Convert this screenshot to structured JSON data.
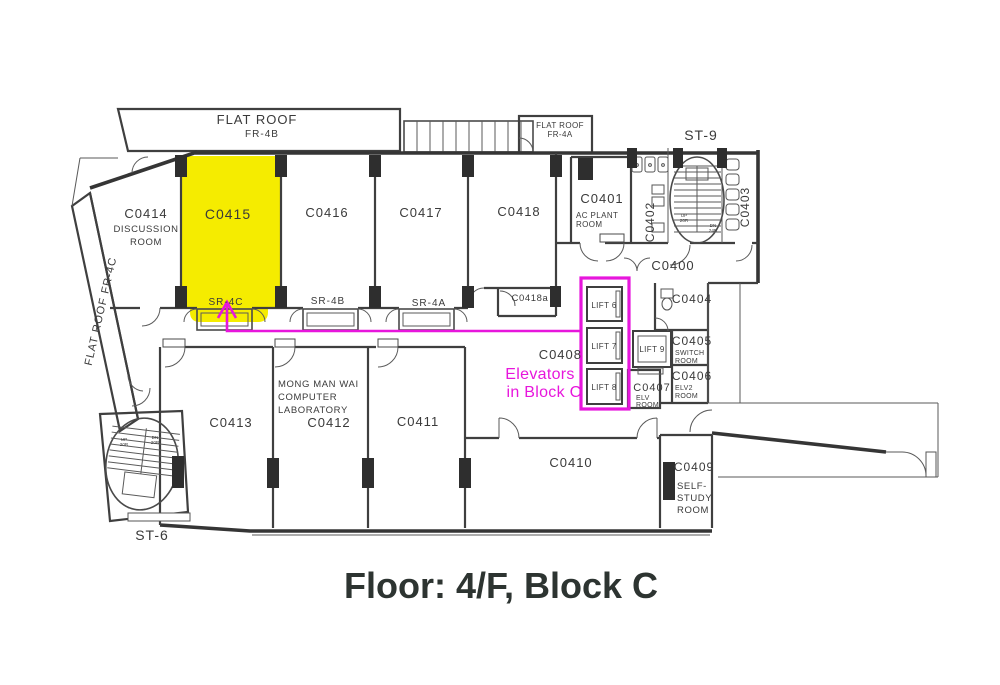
{
  "title": {
    "text": "Floor: 4/F, Block C"
  },
  "colors": {
    "highlight": "#f5ec00",
    "annotation": "#e716dc",
    "label": "#3a3a3a",
    "title": "#2d3431"
  },
  "annotation": {
    "line1": "Elevators",
    "line2": "in Block C"
  },
  "roofs": {
    "fr4b": {
      "name": "FLAT ROOF",
      "code": "FR-4B"
    },
    "fr4a": {
      "name": "FLAT ROOF",
      "code": "FR-4A"
    },
    "fr4c": {
      "name": "FLAT ROOF FR-4C"
    }
  },
  "stairs": {
    "st9": {
      "label": "ST-9",
      "up": "UP",
      "up_risers": "20R",
      "down": "DN",
      "down_risers": "24R"
    },
    "st6": {
      "label": "ST-6",
      "up": "UP",
      "up_risers": "20R",
      "down": "DN",
      "down_risers": "20R"
    }
  },
  "lifts": {
    "lift6": "LIFT 6",
    "lift7": "LIFT 7",
    "lift8": "LIFT 8",
    "lift9": "LIFT 9"
  },
  "service_rooms": {
    "sr4c": "SR-4C",
    "sr4b": "SR-4B",
    "sr4a": "SR-4A"
  },
  "rooms": {
    "c0400": {
      "label": "C0400"
    },
    "c0401": {
      "label": "C0401",
      "line1": "AC PLANT",
      "line2": "ROOM"
    },
    "c0402": {
      "label": "C0402"
    },
    "c0403": {
      "label": "C0403"
    },
    "c0404": {
      "label": "C0404"
    },
    "c0405": {
      "label": "C0405",
      "line1": "SWITCH",
      "line2": "ROOM"
    },
    "c0406": {
      "label": "C0406",
      "line1": "ELV2",
      "line2": "ROOM"
    },
    "c0407": {
      "label": "C0407",
      "line1": "ELV",
      "line2": "ROOM"
    },
    "c0408": {
      "label": "C0408"
    },
    "c0409": {
      "label": "C0409",
      "line1": "SELF-",
      "line2": "STUDY",
      "line3": "ROOM"
    },
    "c0410": {
      "label": "C0410"
    },
    "c0411": {
      "label": "C0411"
    },
    "c0412": {
      "label": "C0412",
      "line1": "MONG MAN WAI",
      "line2": "COMPUTER",
      "line3": "LABORATORY"
    },
    "c0413": {
      "label": "C0413"
    },
    "c0414": {
      "label": "C0414",
      "line1": "DISCUSSION",
      "line2": "ROOM"
    },
    "c0415": {
      "label": "C0415"
    },
    "c0416": {
      "label": "C0416"
    },
    "c0417": {
      "label": "C0417"
    },
    "c0418": {
      "label": "C0418"
    },
    "c0418a": {
      "label": "C0418a"
    }
  }
}
